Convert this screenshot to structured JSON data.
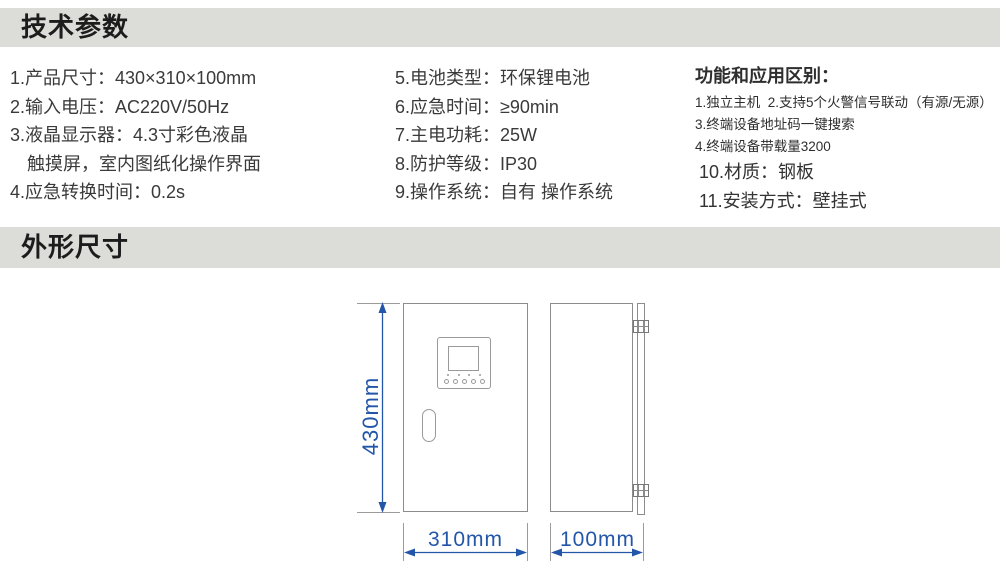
{
  "header_tech": {
    "title": "技术参数"
  },
  "header_dims": {
    "title": "外形尺寸"
  },
  "specs": {
    "column1": [
      "1.产品尺寸：430×310×100mm",
      "2.输入电压：AC220V/50Hz",
      "3.液晶显示器：4.3寸彩色液晶",
      "触摸屏，室内图纸化操作界面",
      "4.应急转换时间：0.2s"
    ],
    "column2": [
      "5.电池类型：环保锂电池",
      "6.应急时间：≥90min",
      "7.主电功耗：25W",
      "8.防护等级：IP30",
      "9.操作系统：自有 操作系统"
    ],
    "column3": {
      "heading": "功能和应用区别：",
      "line1": "1.独立主机  2.支持5个火警信号联动（有源/无源）",
      "line2": "3.终端设备地址码一键搜索",
      "line3": "4.终端设备带载量3200",
      "line4": "10.材质：钢板",
      "line5": "11.安装方式：壁挂式"
    }
  },
  "drawing": {
    "height_dim": "430mm",
    "width_dim": "310mm",
    "depth_dim": "100mm"
  },
  "colors": {
    "header_bg": "#dcdcd9",
    "text": "#3a3a3a",
    "dimension_blue": "#2356a8",
    "outline_gray": "#8c8c8c"
  }
}
